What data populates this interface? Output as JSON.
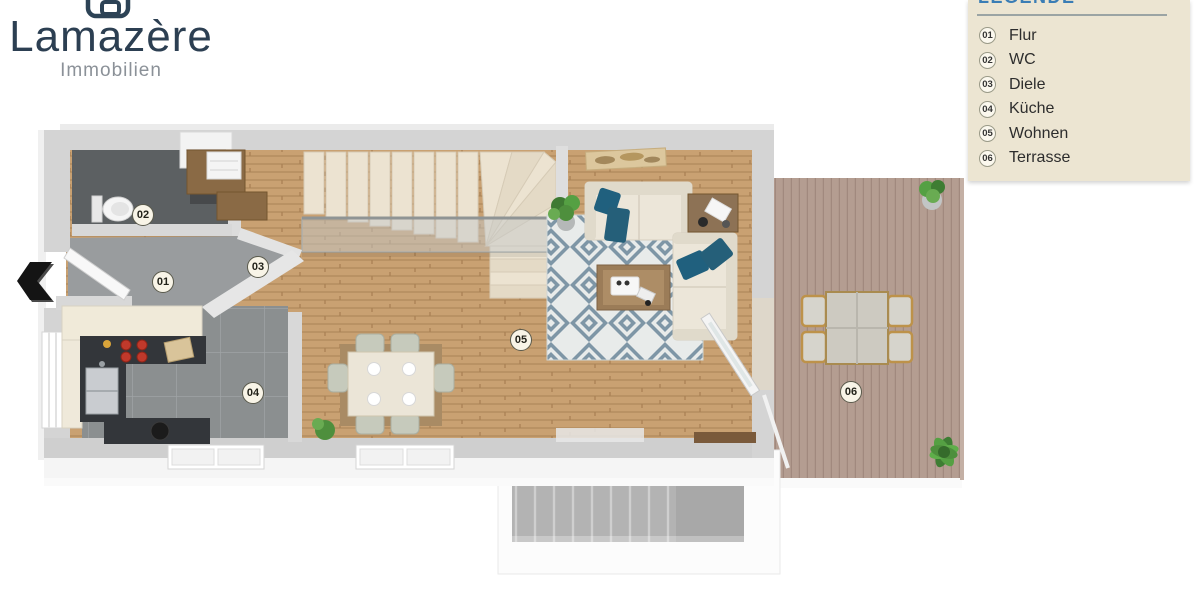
{
  "brand": {
    "name": "Lamazère",
    "tagline": "Immobilien"
  },
  "legend": {
    "title": "LEGENDE",
    "items": [
      {
        "num": "01",
        "label": "Flur"
      },
      {
        "num": "02",
        "label": "WC"
      },
      {
        "num": "03",
        "label": "Diele"
      },
      {
        "num": "04",
        "label": "Küche"
      },
      {
        "num": "05",
        "label": "Wohnen"
      },
      {
        "num": "06",
        "label": "Terrasse"
      }
    ]
  },
  "floorplan": {
    "type": "3d-top-view-floor-plan",
    "badges": [
      {
        "num": "01",
        "room": "Flur"
      },
      {
        "num": "02",
        "room": "WC"
      },
      {
        "num": "03",
        "room": "Diele"
      },
      {
        "num": "04",
        "room": "Küche"
      },
      {
        "num": "05",
        "room": "Wohnen"
      },
      {
        "num": "06",
        "room": "Terrasse"
      }
    ],
    "colors": {
      "brand_navy": "#2c3f52",
      "legend_bg": "#ece5d2",
      "legend_title_blue": "#3a7db5",
      "wood_floor": "#c9a172",
      "terrace_deck": "#b49d91",
      "kitchen_tile": "#8b8f90",
      "wc_tile": "#5c6062",
      "rug_blue": "#7e96a6",
      "sofa_cream": "#ece6d9",
      "pillow_teal": "#20607e",
      "stair_cream": "#ece3d1",
      "counter_dark": "#33363a"
    }
  }
}
